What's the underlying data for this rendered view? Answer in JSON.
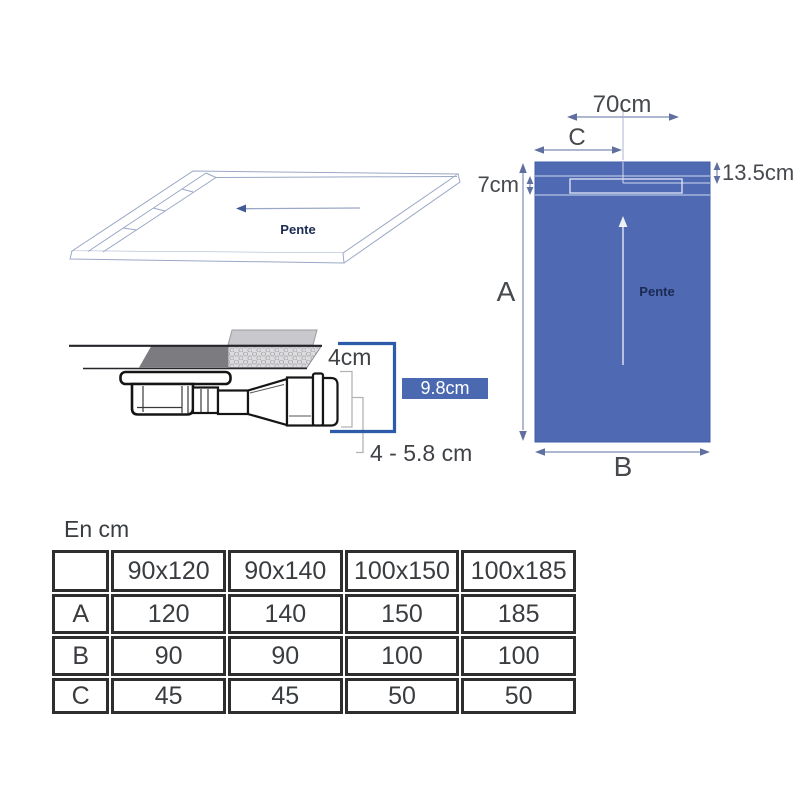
{
  "colors": {
    "tray_blue": "#4f6ab3",
    "badge_blue": "#4a69b1",
    "bracket_blue": "#2e5ba9",
    "drawing_line_gray": "#9aa7c6",
    "text_dark": "#3f4246"
  },
  "iso_view": {
    "pente": "Pente"
  },
  "top_view": {
    "width_70": "70cm",
    "c": "C",
    "a": "A",
    "b": "B",
    "depth_135": "13.5cm",
    "depth_7": "7cm",
    "pente": "Pente"
  },
  "section_view": {
    "h4": "4cm",
    "h98": "9.8cm",
    "h458": "4 - 5.8 cm"
  },
  "table": {
    "title": "En cm",
    "corner": "",
    "columns": [
      "90x120",
      "90x140",
      "100x150",
      "100x185"
    ],
    "rows": [
      {
        "label": "A",
        "values": [
          "120",
          "140",
          "150",
          "185"
        ]
      },
      {
        "label": "B",
        "values": [
          "90",
          "90",
          "100",
          "100"
        ]
      },
      {
        "label": "C",
        "values": [
          "45",
          "45",
          "50",
          "50"
        ]
      }
    ]
  }
}
